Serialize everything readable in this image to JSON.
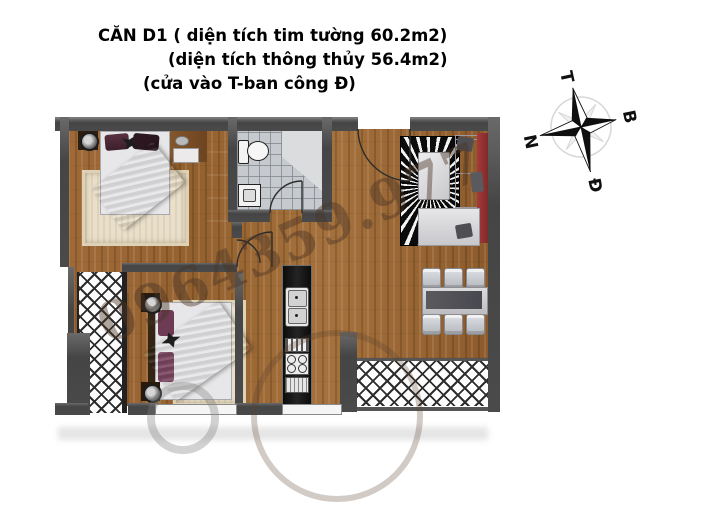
{
  "title": {
    "line1": "CĂN D1 ( diện tích tim tường 60.2m2)",
    "line2": "(diện tích thông thủy 56.4m2)",
    "line3": "(cửa vào T-ban công Đ)"
  },
  "compass": {
    "top": "T",
    "right": "B",
    "left": "N",
    "bottom": "Đ"
  },
  "watermark": {
    "text": "0964359.977"
  },
  "colors": {
    "wall": "#4a4a4a",
    "wood_floor": "#9c6736",
    "bathroom_tile": "#c6c9cd",
    "bed_blanket": "#7d3b5e",
    "sofa_back": "#9c3434",
    "rug_cream": "#e9dfca",
    "living_rug": "#0d0d0d",
    "kitchen_counter": "#161616"
  }
}
